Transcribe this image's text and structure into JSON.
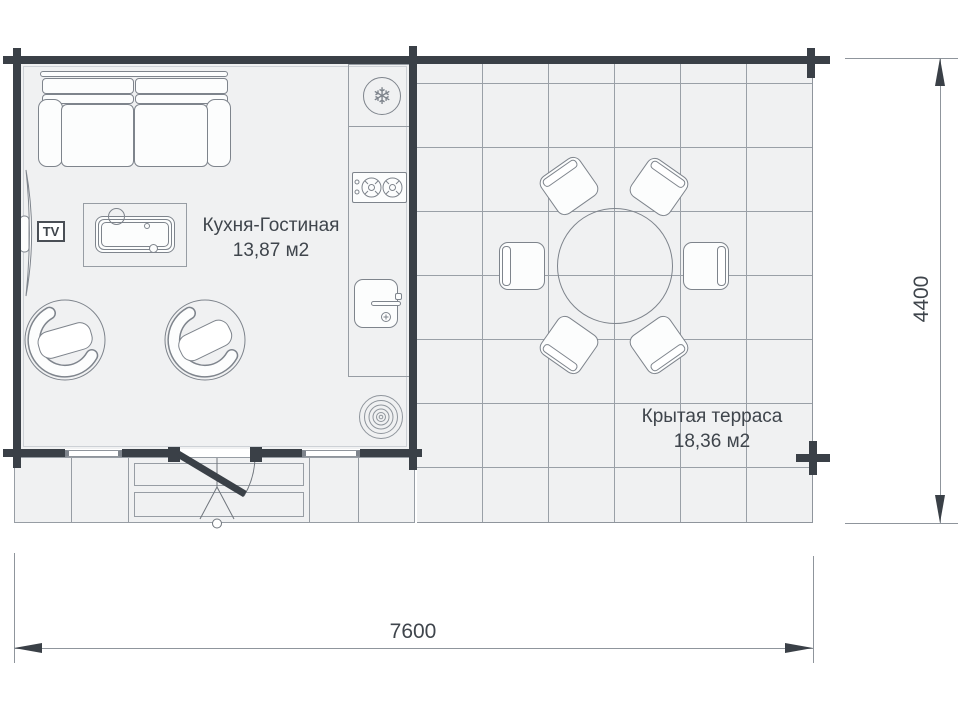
{
  "plan_title": "floor-plan",
  "rooms": [
    {
      "name": "Кухня-Гостиная",
      "area": "13,87 м2"
    },
    {
      "name": "Крытая терраса",
      "area": "18,36 м2"
    }
  ],
  "tv_label": "TV",
  "dimensions": {
    "width": "7600",
    "height": "4400"
  },
  "icons": {
    "snowflake": "❄"
  },
  "colors": {
    "wall": "#3a4047",
    "furniture_line": "#7e848c",
    "grid_line": "#9aa0a7",
    "floor": "#f0f1f2",
    "text": "#3f454c"
  }
}
